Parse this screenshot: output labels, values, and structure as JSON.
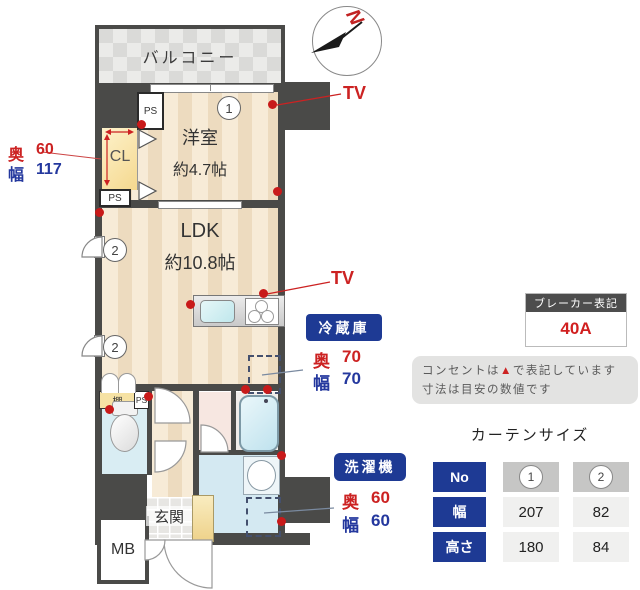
{
  "plan": {
    "balcony": "バルコニー",
    "compass_north": "N",
    "room": {
      "name": "洋室",
      "size": "約4.7帖"
    },
    "ldk": {
      "name": "LDK",
      "size": "約10.8帖"
    },
    "closet": {
      "label": "CL",
      "depth_label": "奥",
      "depth_value": "60",
      "width_label": "幅",
      "width_value": "117"
    },
    "ps": "PS",
    "shelf": "棚",
    "entrance": "玄関",
    "meter_box": "MB",
    "tv": "TV",
    "window1_no": "1",
    "window2_no": "2",
    "fridge": {
      "title": "冷蔵庫",
      "depth_label": "奥",
      "depth_value": "70",
      "width_label": "幅",
      "width_value": "70"
    },
    "washer": {
      "title": "洗濯機",
      "depth_label": "奥",
      "depth_value": "60",
      "width_label": "幅",
      "width_value": "60"
    }
  },
  "breaker": {
    "title": "ブレーカー表記",
    "value": "40A"
  },
  "note": {
    "line1_before": "コンセントは",
    "marker": "▲",
    "line1_after": "で表記しています",
    "line2": "寸法は目安の数値です"
  },
  "curtain": {
    "title": "カーテンサイズ",
    "rows": [
      "No",
      "幅",
      "高さ"
    ],
    "columns": [
      {
        "no": "1",
        "width": "207",
        "height": "180"
      },
      {
        "no": "2",
        "width": "82",
        "height": "84"
      }
    ]
  },
  "colors": {
    "accent_navy": "#1e3a94",
    "accent_red": "#cc2222",
    "wall": "#4a4a48"
  }
}
